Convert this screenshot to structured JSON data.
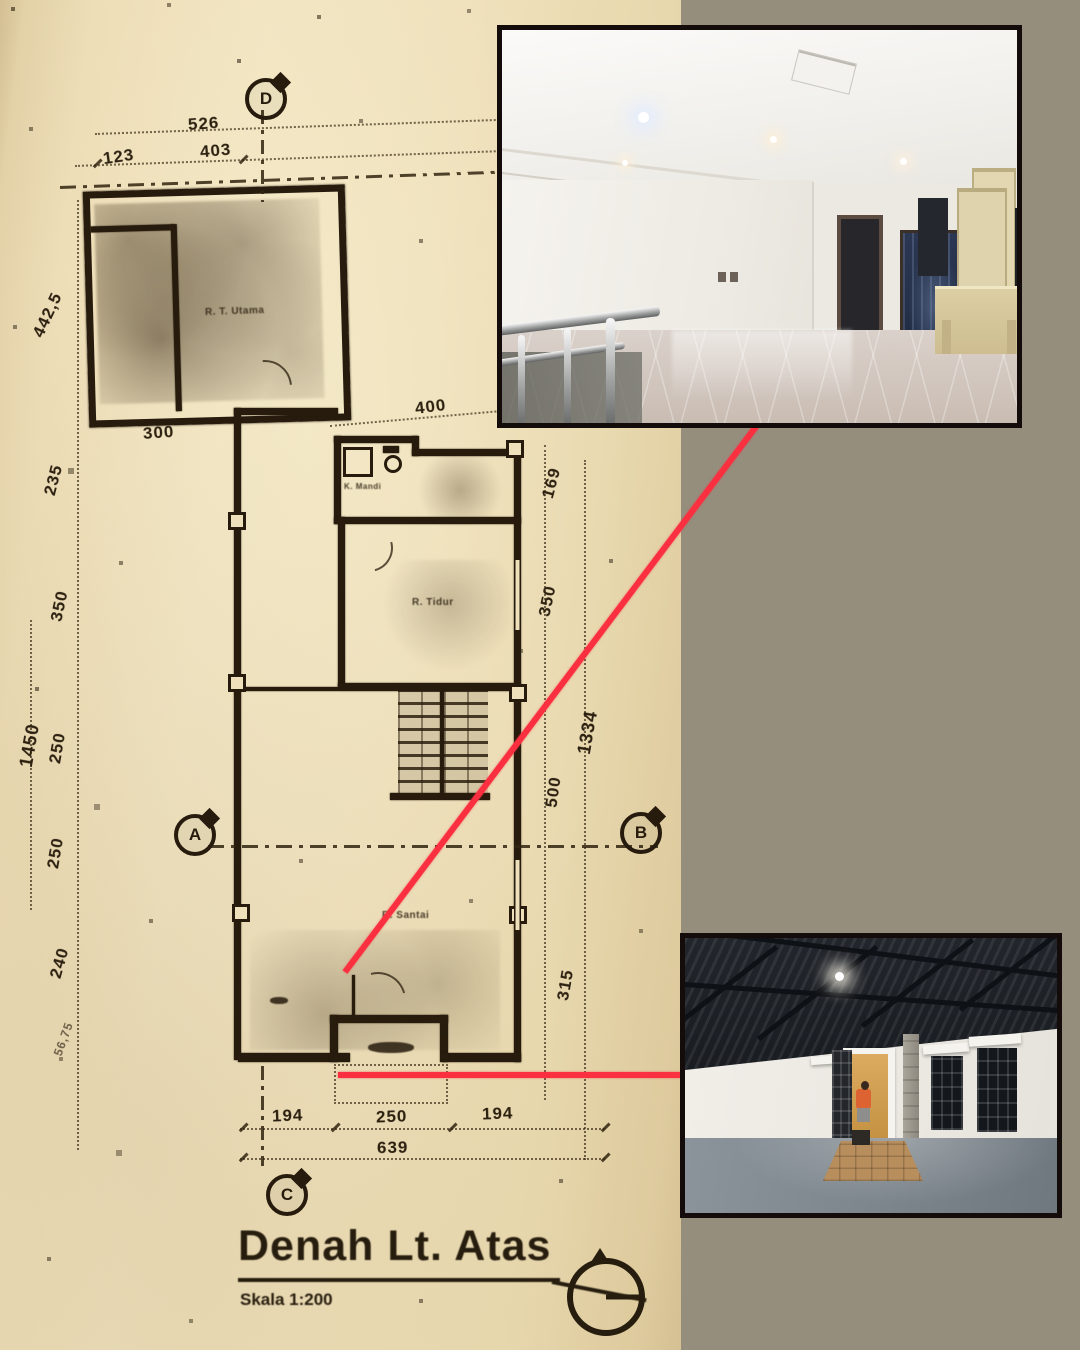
{
  "colors": {
    "background": "#968e7d",
    "paper": "#eee0ba",
    "ink": "#261b0d",
    "red_callout": "#fa2f3f",
    "photo_border": "#140c0a"
  },
  "floor_plan": {
    "title": "Denah Lt. Atas",
    "scale_label": "Skala 1:200",
    "axis_markers": [
      "D",
      "A",
      "B",
      "C"
    ],
    "room_labels": [
      "R. T. Utama",
      "K. Mandi",
      "R. Tidur",
      "R. Santai"
    ],
    "dimensions": {
      "top": [
        "526",
        "123",
        "403"
      ],
      "left": [
        "442,5",
        "235",
        "350",
        "1450",
        "250",
        "250",
        "240",
        "56,75"
      ],
      "inner": [
        "300",
        "400"
      ],
      "right": [
        "169",
        "350",
        "1334",
        "500",
        "315"
      ],
      "bottom": [
        "194",
        "250",
        "194",
        "639"
      ]
    }
  },
  "photos": {
    "upper": {
      "name": "interior-upper-floor-hall"
    },
    "lower": {
      "name": "interior-rooftop-room"
    }
  }
}
